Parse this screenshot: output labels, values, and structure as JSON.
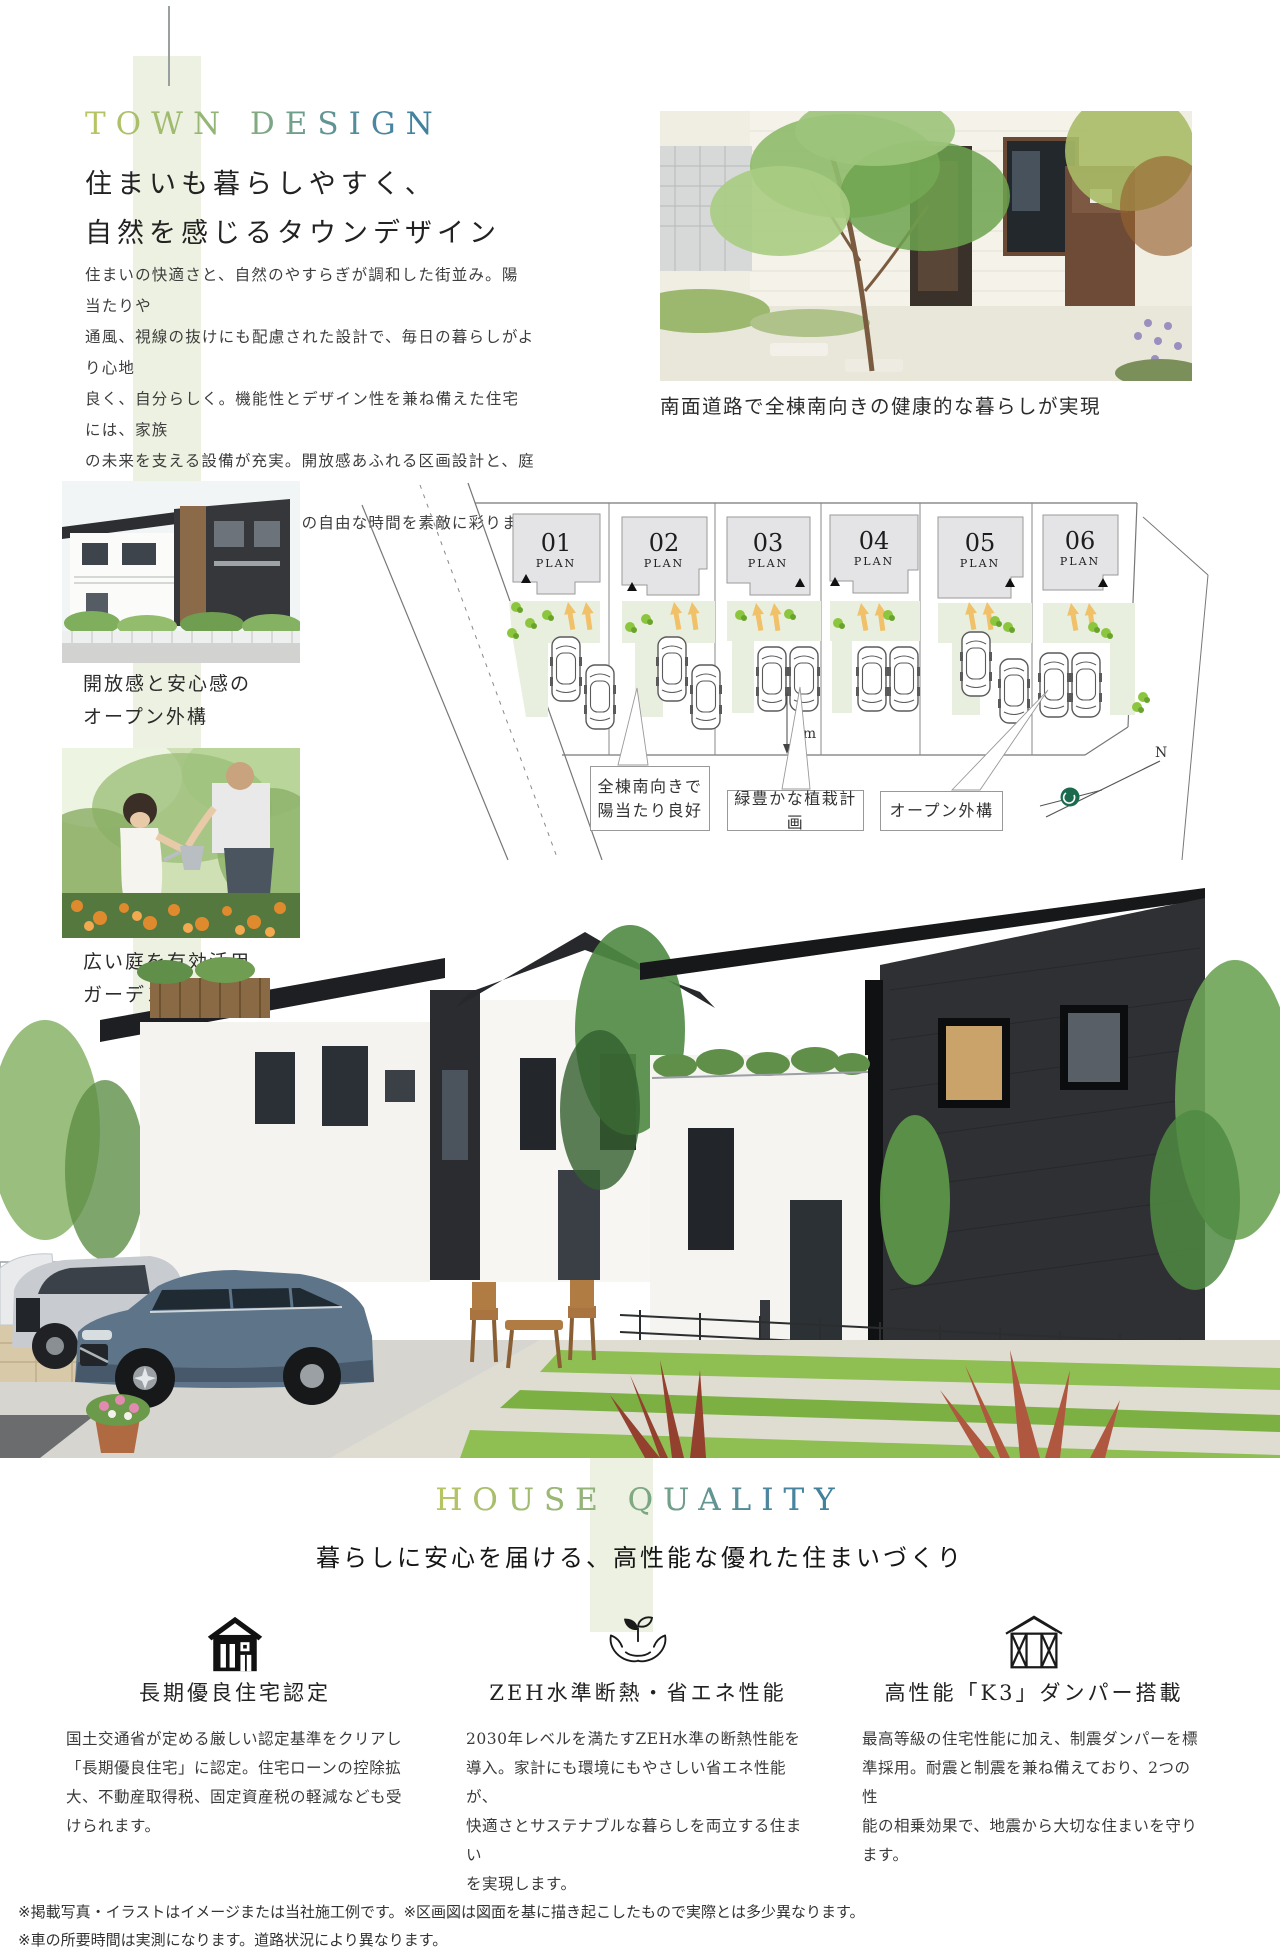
{
  "town_design": {
    "label": "TOWN DESIGN",
    "title_lines": [
      "住まいも暮らしやすく、",
      "自然を感じるタウンデザイン"
    ],
    "body_lines": [
      "住まいの快適さと、自然のやすらぎが調和した街並み。陽当たりや",
      "通風、視線の抜けにも配慮された設計で、毎日の暮らしがより心地",
      "良く、自分らしく。機能性とデザイン性を兼ね備えた住宅には、家族",
      "の未来を支える設備が充実。開放感あふれる区画設計と、庭のある",
      "ゆとりの住空間が、ご家族との自由な時間を素敵に彩ります。"
    ],
    "photo_caption": "南面道路で全棟南向きの健康的な暮らしが実現",
    "photo1_caption_lines": [
      "開放感と安心感の",
      "オープン外構"
    ],
    "photo2_caption_lines": [
      "広い庭を有効活用",
      "ガーデンスペース"
    ]
  },
  "site_plan": {
    "plan_label": "PLAN",
    "plots": [
      {
        "num": "01"
      },
      {
        "num": "02"
      },
      {
        "num": "03"
      },
      {
        "num": "04"
      },
      {
        "num": "05"
      },
      {
        "num": "06"
      }
    ],
    "dimension_label": "4m",
    "north_label": "N",
    "callout1_lines": [
      "全棟南向きで",
      "陽当たり良好"
    ],
    "callout2": "緑豊かな植栽計画",
    "callout3": "オープン外構"
  },
  "house_quality": {
    "label": "HOUSE QUALITY",
    "subtitle": "暮らしに安心を届ける、高性能な優れた住まいづくり",
    "features": [
      {
        "icon": "certified-house-icon",
        "title": "長期優良住宅認定",
        "body_lines": [
          "国土交通省が定める厳しい認定基準をクリアし",
          "「長期優良住宅」に認定。住宅ローンの控除拡",
          "大、不動産取得税、固定資産税の軽減なども受",
          "けられます。"
        ]
      },
      {
        "icon": "hands-sprout-icon",
        "title": "ZEH水準断熱・省エネ性能",
        "body_lines": [
          "2030年レベルを満たすZEH水準の断熱性能を",
          "導入。家計にも環境にもやさしい省エネ性能が、",
          "快適さとサステナブルな暮らしを両立する住まい",
          "を実現します。"
        ]
      },
      {
        "icon": "braced-frame-icon",
        "title": "高性能「K3」ダンパー搭載",
        "body_lines": [
          "最高等級の住宅性能に加え、制震ダンパーを標",
          "準採用。耐震と制震を兼ね備えており、2つの性",
          "能の相乗効果で、地震から大切な住まいを守り",
          "ます。"
        ]
      }
    ]
  },
  "footer": {
    "line1": "※掲載写真・イラストはイメージまたは当社施工例です。※区画図は図面を基に描き起こしたもので実際とは多少異なります。",
    "line2": "※車の所要時間は実測になります。道路状況により異なります。"
  },
  "colors": {
    "accent_gradient_start": "#b9c562",
    "accent_gradient_end": "#3d7f9d",
    "band_green": "#edf1e1",
    "plan_ground_green": "#e9efdf",
    "arrow_orange": "#f0c169",
    "bush_green": "#8cc63f",
    "compass_green": "#1c6b4f"
  }
}
